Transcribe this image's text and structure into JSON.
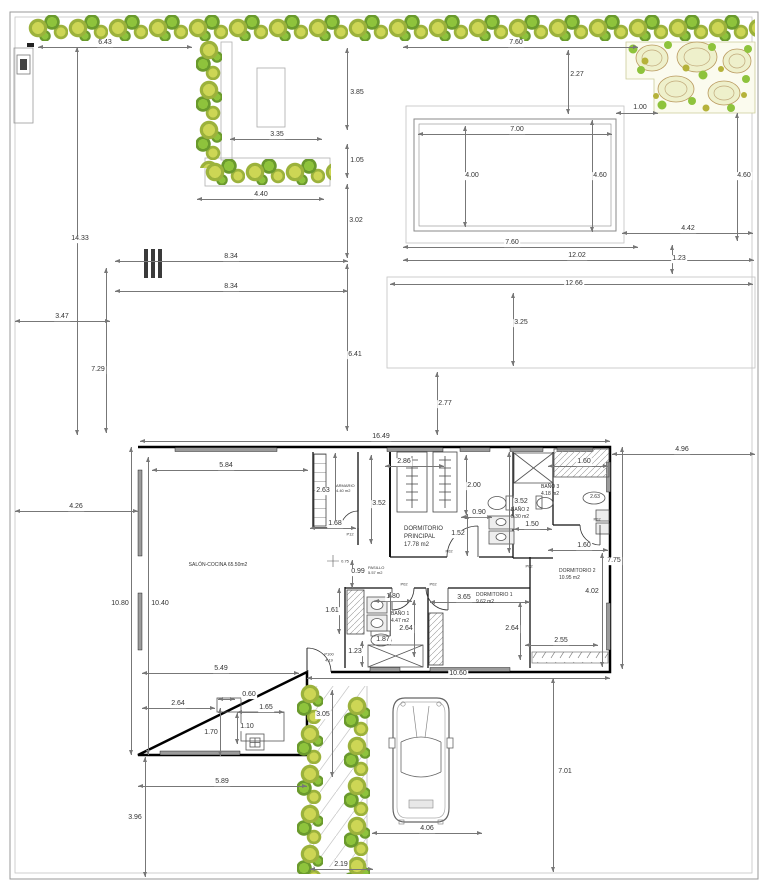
{
  "meta": {
    "type": "architectural floor plan with garden, pool and parking",
    "units": "m"
  },
  "colors": {
    "g1": "#cdd655",
    "g2": "#9cb23c",
    "g3": "#8ec33c",
    "g4": "#6a9a2d"
  },
  "dimensions": [
    {
      "label": "6.43",
      "o": "h",
      "x": 38,
      "y": 47,
      "len": 154,
      "lx": 105,
      "ly": 43
    },
    {
      "label": "3.85",
      "o": "v",
      "x": 347,
      "y": 48,
      "len": 82,
      "lx": 357,
      "ly": 93
    },
    {
      "label": "3.35",
      "o": "h",
      "x": 230,
      "y": 139,
      "len": 92,
      "lx": 277,
      "ly": 135
    },
    {
      "label": "1.05",
      "o": "v",
      "x": 347,
      "y": 144,
      "len": 34,
      "lx": 357,
      "ly": 161
    },
    {
      "label": "4.40",
      "o": "h",
      "x": 197,
      "y": 199,
      "len": 127,
      "lx": 261,
      "ly": 195
    },
    {
      "label": "3.02",
      "o": "v",
      "x": 347,
      "y": 184,
      "len": 74,
      "lx": 356,
      "ly": 221
    },
    {
      "label": "14.33",
      "o": "v",
      "x": 77,
      "y": 47,
      "len": 388,
      "lx": 80,
      "ly": 239
    },
    {
      "label": "8.34",
      "o": "h",
      "x": 115,
      "y": 261,
      "len": 233,
      "lx": 231,
      "ly": 257
    },
    {
      "label": "8.34",
      "o": "h",
      "x": 115,
      "y": 291,
      "len": 233,
      "lx": 231,
      "ly": 287
    },
    {
      "label": "3.47",
      "o": "h",
      "x": 15,
      "y": 321,
      "len": 95,
      "lx": 62,
      "ly": 317
    },
    {
      "label": "7.29",
      "o": "v",
      "x": 106,
      "y": 268,
      "len": 165,
      "lx": 98,
      "ly": 370
    },
    {
      "label": "6.41",
      "o": "v",
      "x": 347,
      "y": 264,
      "len": 167,
      "lx": 355,
      "ly": 355
    },
    {
      "label": "7.60",
      "o": "h",
      "x": 403,
      "y": 47,
      "len": 235,
      "lx": 516,
      "ly": 43
    },
    {
      "label": "2.27",
      "o": "v",
      "x": 568,
      "y": 50,
      "len": 64,
      "lx": 577,
      "ly": 75
    },
    {
      "label": "1.00",
      "o": "h",
      "x": 616,
      "y": 113,
      "len": 42,
      "lx": 640,
      "ly": 108
    },
    {
      "label": "7.00",
      "o": "h",
      "x": 418,
      "y": 134,
      "len": 194,
      "lx": 517,
      "ly": 130
    },
    {
      "label": "4.00",
      "o": "v",
      "x": 465,
      "y": 126,
      "len": 101,
      "lx": 472,
      "ly": 176
    },
    {
      "label": "4.60",
      "o": "v",
      "x": 592,
      "y": 120,
      "len": 112,
      "lx": 600,
      "ly": 176
    },
    {
      "label": "4.60",
      "o": "v",
      "x": 737,
      "y": 113,
      "len": 128,
      "lx": 744,
      "ly": 176
    },
    {
      "label": "4.42",
      "o": "h",
      "x": 622,
      "y": 233,
      "len": 131,
      "lx": 688,
      "ly": 229
    },
    {
      "label": "7.60",
      "o": "h",
      "x": 403,
      "y": 247,
      "len": 235,
      "lx": 512,
      "ly": 243
    },
    {
      "label": "12.02",
      "o": "h",
      "x": 403,
      "y": 260,
      "len": 351,
      "lx": 577,
      "ly": 256
    },
    {
      "label": "1.23",
      "o": "v",
      "x": 672,
      "y": 245,
      "len": 29,
      "lx": 679,
      "ly": 259
    },
    {
      "label": "12.66",
      "o": "h",
      "x": 390,
      "y": 284,
      "len": 363,
      "lx": 574,
      "ly": 284
    },
    {
      "label": "3.25",
      "o": "v",
      "x": 513,
      "y": 293,
      "len": 73,
      "lx": 521,
      "ly": 323
    },
    {
      "label": "2.77",
      "o": "v",
      "x": 437,
      "y": 372,
      "len": 63,
      "lx": 445,
      "ly": 404
    },
    {
      "label": "16.49",
      "o": "h",
      "x": 140,
      "y": 441,
      "len": 470,
      "lx": 381,
      "ly": 437
    },
    {
      "label": "4.96",
      "o": "h",
      "x": 612,
      "y": 454,
      "len": 143,
      "lx": 682,
      "ly": 450
    },
    {
      "label": "4.26",
      "o": "h",
      "x": 15,
      "y": 511,
      "len": 123,
      "lx": 76,
      "ly": 507
    },
    {
      "label": "5.84",
      "o": "h",
      "x": 152,
      "y": 470,
      "len": 156,
      "lx": 226,
      "ly": 466
    },
    {
      "label": "2.63",
      "o": "v",
      "x": 335,
      "y": 453,
      "len": 74,
      "lx": 323,
      "ly": 491
    },
    {
      "label": "1.68",
      "o": "h",
      "x": 310,
      "y": 528,
      "len": 46,
      "lx": 335,
      "ly": 524
    },
    {
      "label": "3.52",
      "o": "v",
      "x": 371,
      "y": 455,
      "len": 89,
      "lx": 379,
      "ly": 504
    },
    {
      "label": "2.86",
      "o": "h",
      "x": 385,
      "y": 466,
      "len": 59,
      "lx": 404,
      "ly": 462
    },
    {
      "label": "2.00",
      "o": "v",
      "x": 466,
      "y": 455,
      "len": 60,
      "lx": 474,
      "ly": 486
    },
    {
      "label": "0.90",
      "o": "h",
      "x": 461,
      "y": 517,
      "len": 31,
      "lx": 479,
      "ly": 513
    },
    {
      "label": "3.52",
      "o": "v",
      "x": 509,
      "y": 452,
      "len": 101,
      "lx": 521,
      "ly": 502
    },
    {
      "label": "1.50",
      "o": "h",
      "x": 514,
      "y": 529,
      "len": 38,
      "lx": 532,
      "ly": 525
    },
    {
      "label": "1.60",
      "o": "h",
      "x": 548,
      "y": 466,
      "len": 60,
      "lx": 584,
      "ly": 462
    },
    {
      "label": "1.60",
      "o": "h",
      "x": 548,
      "y": 550,
      "len": 60,
      "lx": 584,
      "ly": 546
    },
    {
      "label": "4.02",
      "o": "v",
      "x": 602,
      "y": 553,
      "len": 114,
      "lx": 592,
      "ly": 592
    },
    {
      "label": "7.75",
      "o": "v",
      "x": 622,
      "y": 447,
      "len": 222,
      "lx": 614,
      "ly": 561
    },
    {
      "label": "1.52",
      "o": "v",
      "x": 467,
      "y": 514,
      "len": 42,
      "lx": 458,
      "ly": 534
    },
    {
      "label": "0.99",
      "o": "v",
      "x": 352,
      "y": 560,
      "len": 28,
      "lx": 358,
      "ly": 572
    },
    {
      "label": "1.61",
      "o": "v",
      "x": 339,
      "y": 588,
      "len": 46,
      "lx": 332,
      "ly": 611
    },
    {
      "label": "1.80",
      "o": "h",
      "x": 374,
      "y": 601,
      "len": 38,
      "lx": 393,
      "ly": 597
    },
    {
      "label": "2.64",
      "o": "v",
      "x": 414,
      "y": 600,
      "len": 57,
      "lx": 406,
      "ly": 629
    },
    {
      "label": "1.23",
      "o": "v",
      "x": 362,
      "y": 641,
      "len": 26,
      "lx": 355,
      "ly": 652
    },
    {
      "label": "1.87",
      "o": "v",
      "x": 390,
      "y": 592,
      "len": 53,
      "lx": 383,
      "ly": 640
    },
    {
      "label": "3.65",
      "o": "h",
      "x": 430,
      "y": 602,
      "len": 100,
      "lx": 464,
      "ly": 598
    },
    {
      "label": "2.64",
      "o": "v",
      "x": 520,
      "y": 602,
      "len": 58,
      "lx": 512,
      "ly": 629
    },
    {
      "label": "2.55",
      "o": "h",
      "x": 525,
      "y": 645,
      "len": 73,
      "lx": 561,
      "ly": 641
    },
    {
      "label": "10.80",
      "o": "v",
      "x": 131,
      "y": 447,
      "len": 308,
      "lx": 120,
      "ly": 604
    },
    {
      "label": "10.40",
      "o": "v",
      "x": 148,
      "y": 457,
      "len": 298,
      "lx": 160,
      "ly": 604
    },
    {
      "label": "5.49",
      "o": "h",
      "x": 142,
      "y": 673,
      "len": 157,
      "lx": 221,
      "ly": 669
    },
    {
      "label": "2.64",
      "o": "h",
      "x": 142,
      "y": 708,
      "len": 73,
      "lx": 178,
      "ly": 704
    },
    {
      "label": "0.60",
      "o": "h",
      "x": 218,
      "y": 699,
      "len": 17,
      "lx": 249,
      "ly": 695
    },
    {
      "label": "1.65",
      "o": "h",
      "x": 237,
      "y": 712,
      "len": 47,
      "lx": 266,
      "ly": 708
    },
    {
      "label": "1.10",
      "o": "v",
      "x": 237,
      "y": 713,
      "len": 31,
      "lx": 247,
      "ly": 727
    },
    {
      "label": "1.70",
      "o": "v",
      "x": 220,
      "y": 708,
      "len": 48,
      "lx": 211,
      "ly": 733
    },
    {
      "label": "5.89",
      "o": "h",
      "x": 138,
      "y": 786,
      "len": 169,
      "lx": 222,
      "ly": 782
    },
    {
      "label": "3.96",
      "o": "v",
      "x": 145,
      "y": 757,
      "len": 120,
      "lx": 135,
      "ly": 818
    },
    {
      "label": "10.60",
      "o": "h",
      "x": 307,
      "y": 678,
      "len": 303,
      "lx": 458,
      "ly": 674
    },
    {
      "label": "7.01",
      "o": "v",
      "x": 553,
      "y": 678,
      "len": 194,
      "lx": 565,
      "ly": 772
    },
    {
      "label": "4.06",
      "o": "h",
      "x": 372,
      "y": 833,
      "len": 110,
      "lx": 427,
      "ly": 829
    },
    {
      "label": "3.05",
      "o": "v",
      "x": 332,
      "y": 690,
      "len": 87,
      "lx": 323,
      "ly": 715
    },
    {
      "label": "2.19",
      "o": "h",
      "x": 310,
      "y": 869,
      "len": 63,
      "lx": 341,
      "ly": 865
    }
  ],
  "rooms": [
    {
      "name": "salon-cocina",
      "lines": [
        "SALÓN-COCINA  65.50m2"
      ],
      "x": 218,
      "y": 565,
      "s": 5,
      "align": "center"
    },
    {
      "name": "armario",
      "lines": [
        "ARMARIO",
        "4.40 m2"
      ],
      "x": 336,
      "y": 483,
      "s": 4,
      "align": "left"
    },
    {
      "name": "dormitorio-principal",
      "lines": [
        "DORMITORIO",
        "PRINCIPAL",
        "17.78 m2"
      ],
      "x": 404,
      "y": 526,
      "s": 6,
      "align": "left"
    },
    {
      "name": "pasillo",
      "lines": [
        "PASILLO",
        "5.57 m2"
      ],
      "x": 368,
      "y": 565,
      "s": 4,
      "align": "left"
    },
    {
      "name": "bano-2",
      "lines": [
        "BAÑO 2",
        "5.30 m2"
      ],
      "x": 511,
      "y": 507,
      "s": 5,
      "align": "left"
    },
    {
      "name": "bano-3",
      "lines": [
        "BAÑO 3",
        "4.18 m2"
      ],
      "x": 541,
      "y": 484,
      "s": 5,
      "align": "left"
    },
    {
      "name": "bano-1",
      "lines": [
        "BAÑO 1",
        "4.47 m2"
      ],
      "x": 391,
      "y": 611,
      "s": 5,
      "align": "left"
    },
    {
      "name": "dormitorio-1",
      "lines": [
        "DORMITORIO 1",
        "9.62 m2"
      ],
      "x": 476,
      "y": 592,
      "s": 5,
      "align": "left"
    },
    {
      "name": "dormitorio-2",
      "lines": [
        "DORMITORIO 2",
        "10.95 m2"
      ],
      "x": 559,
      "y": 568,
      "s": 5,
      "align": "left"
    }
  ],
  "doors": [
    {
      "label": "P12",
      "x": 350,
      "y": 534
    },
    {
      "label": "P02",
      "x": 449,
      "y": 551
    },
    {
      "label": "P02",
      "x": 529,
      "y": 566
    },
    {
      "label": "P02",
      "x": 404,
      "y": 584
    },
    {
      "label": "P02",
      "x": 433,
      "y": 584
    },
    {
      "label": "P02",
      "x": 597,
      "y": 519
    },
    {
      "label": "P100",
      "x": 329,
      "y": 654
    }
  ],
  "annotations": [
    {
      "label": "0.75",
      "x": 345,
      "y": 561,
      "s": 4
    },
    {
      "label": "2.63",
      "x": 595,
      "y": 497,
      "s": 5
    },
    {
      "label": "4.19",
      "x": 329,
      "y": 660,
      "s": 4
    }
  ]
}
